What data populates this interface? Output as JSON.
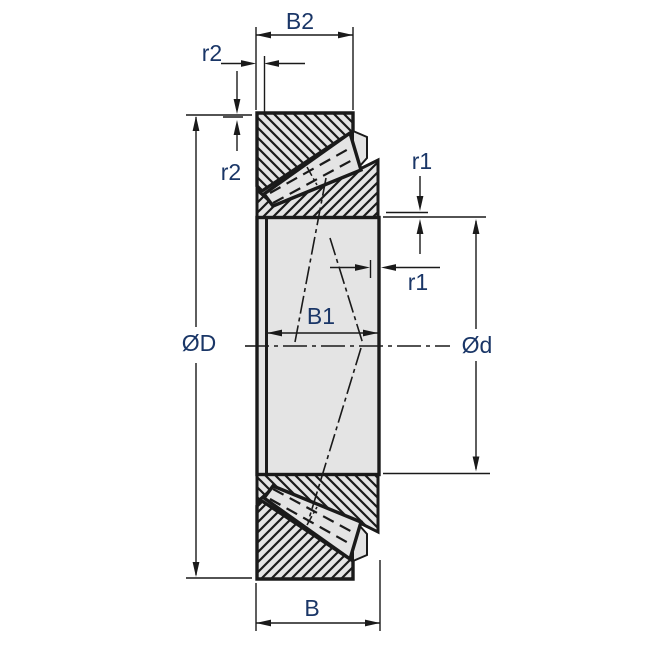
{
  "drawing": {
    "labels": {
      "cup_width": "B2",
      "outer_chamfer_width": "r2",
      "outer_chamfer_height": "r2",
      "inner_chamfer_height": "r1",
      "inner_chamfer_width": "r1",
      "inner_ring_width": "B1",
      "outer_diameter": "ØD",
      "bore_diameter": "Ød",
      "total_width": "B"
    },
    "colors": {
      "line": "#1a1a1a",
      "part_fill": "#e4e4e4",
      "label_text": "#1a3667",
      "background": "#ffffff"
    }
  }
}
